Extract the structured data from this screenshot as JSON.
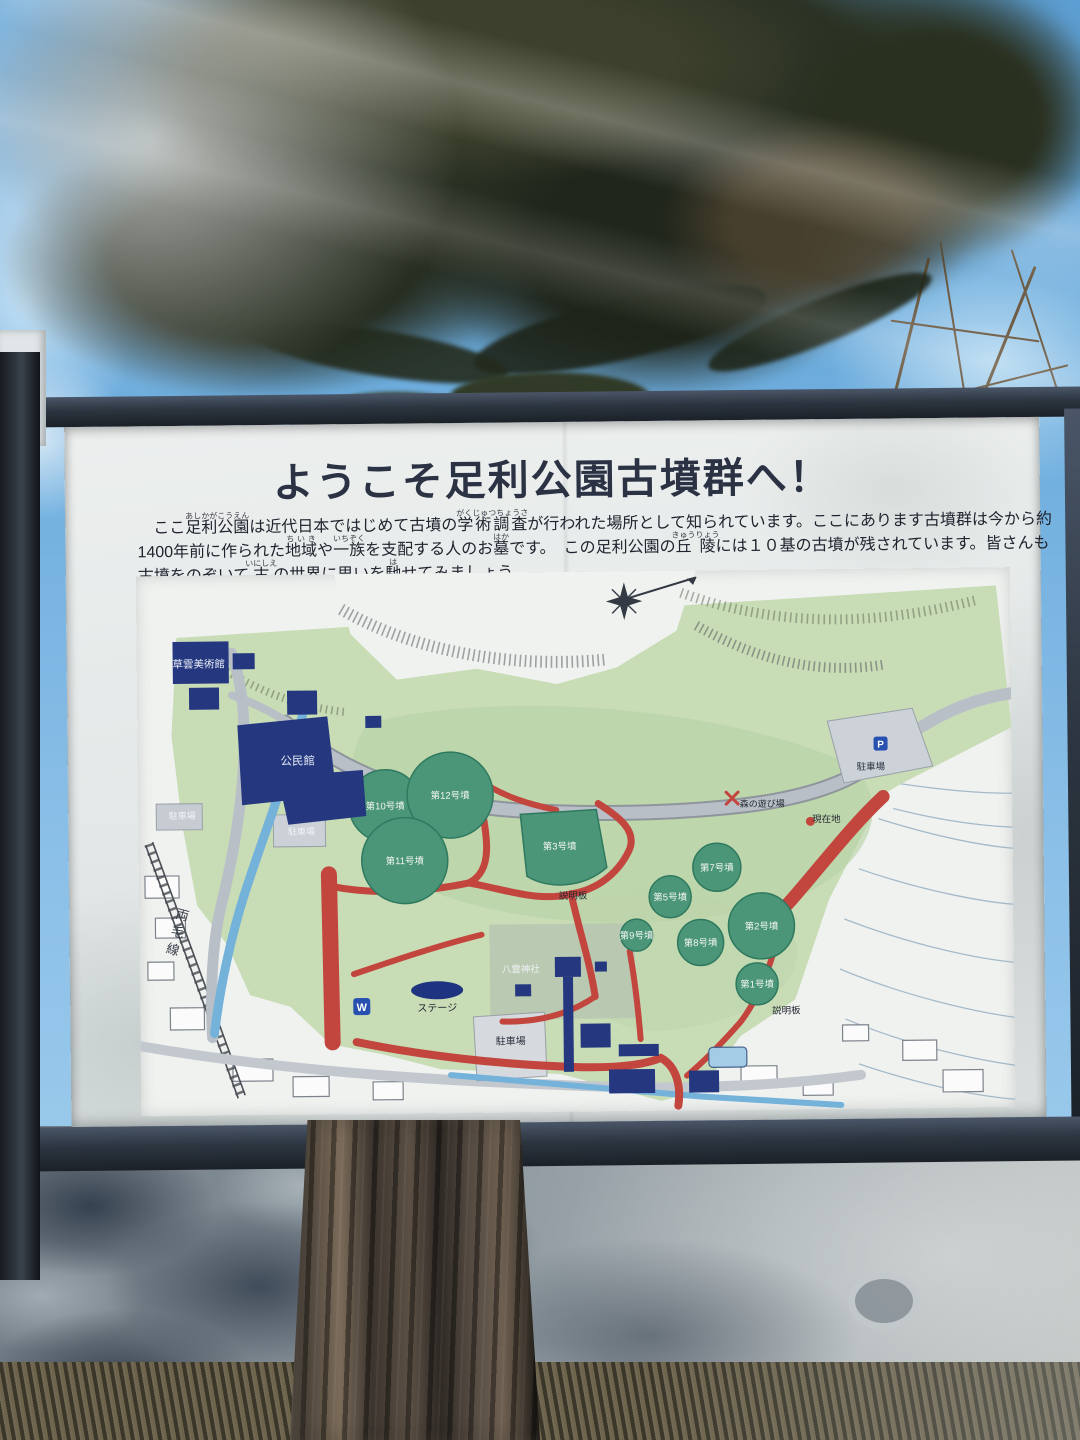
{
  "sign": {
    "title": "ようこそ足利公園古墳群へ！",
    "paragraph": {
      "lines": [
        {
          "segments": [
            {
              "t": "　ここ"
            },
            {
              "t": "足利公園",
              "ruby": "あしかがこうえん"
            },
            {
              "t": "は近代日本ではじめて古墳の"
            },
            {
              "t": "学術調査",
              "ruby": "がくじゅつちょうさ"
            },
            {
              "t": "が行われた場所として知られています。ここにあります古墳群は今から約"
            }
          ]
        },
        {
          "segments": [
            {
              "t": "1400年前に作られた"
            },
            {
              "t": "地域",
              "ruby": "ちいき"
            },
            {
              "t": "や"
            },
            {
              "t": "一族",
              "ruby": "いちぞく"
            },
            {
              "t": "を支配する人のお"
            },
            {
              "t": "墓",
              "ruby": "はか"
            },
            {
              "t": "です。　この足利公園の"
            },
            {
              "t": "丘陵",
              "ruby": "きゅうりょう"
            },
            {
              "t": "には１０基の古墳が残されています。皆さんも"
            }
          ]
        },
        {
          "segments": [
            {
              "t": "古墳をのぞいて"
            },
            {
              "t": "古",
              "ruby": "いにしえ"
            },
            {
              "t": "の世界に思いを"
            },
            {
              "t": "馳",
              "ruby": "は"
            },
            {
              "t": "せてみましょう。"
            }
          ]
        }
      ]
    },
    "map": {
      "colors": {
        "park_green": "#c8dcb6",
        "hill_green": "#b9d2a6",
        "mound_green": "#4b9678",
        "mound_rim": "#2f7a5f",
        "trail_red": "#c2463e",
        "water_blue": "#74b2da",
        "building_navy": "#24377f",
        "road_gray": "#b9bfc7",
        "label_white": "#eef2f5",
        "label_dark": "#262b33"
      },
      "mounds": [
        {
          "name": "第10号墳",
          "cx": 247,
          "cy": 232,
          "r": 36
        },
        {
          "name": "第12号墳",
          "cx": 312,
          "cy": 222,
          "r": 43
        },
        {
          "name": "第11号墳",
          "cx": 266,
          "cy": 287,
          "r": 43
        },
        {
          "name": "第3号墳",
          "shape": "fan",
          "cx": 421,
          "cy": 274,
          "r": 0
        },
        {
          "name": "第7号墳",
          "cx": 578,
          "cy": 297,
          "r": 24
        },
        {
          "name": "第5号墳",
          "cx": 531,
          "cy": 326,
          "r": 21
        },
        {
          "name": "第2号墳",
          "cx": 622,
          "cy": 356,
          "r": 33
        },
        {
          "name": "第9号墳",
          "cx": 497,
          "cy": 364,
          "r": 16
        },
        {
          "name": "第8号墳",
          "cx": 561,
          "cy": 372,
          "r": 23
        },
        {
          "name": "第1号墳",
          "cx": 617,
          "cy": 414,
          "r": 21
        }
      ],
      "labels": [
        {
          "text": "草雲美術館",
          "x": 62,
          "y": 92,
          "size": 10.5,
          "color": "#e9eef6"
        },
        {
          "text": "公民館",
          "x": 160,
          "y": 190,
          "size": 11.5,
          "color": "#e2e9f2"
        },
        {
          "text": "駐車場",
          "x": 44,
          "y": 243,
          "size": 9,
          "color": "#f0f3f6"
        },
        {
          "text": "駐車場",
          "x": 163,
          "y": 260,
          "size": 9,
          "color": "#eef2f5"
        },
        {
          "text": "駐車場",
          "x": 733,
          "y": 201,
          "size": 9.5,
          "color": "#2c3340"
        },
        {
          "text": "駐車場",
          "x": 370,
          "y": 472,
          "size": 10,
          "color": "#2c3340"
        },
        {
          "text": "説明板",
          "x": 434,
          "y": 327,
          "size": 9.5,
          "color": "#20262e"
        },
        {
          "text": "説明板",
          "x": 646,
          "y": 444,
          "size": 9.5,
          "color": "#20262e"
        },
        {
          "text": "ステージ",
          "x": 297,
          "y": 438,
          "size": 10,
          "color": "#222831"
        },
        {
          "text": "八雲神社",
          "x": 381,
          "y": 400,
          "size": 9.5,
          "color": "#edf1f4"
        },
        {
          "text": "森の遊び場",
          "x": 624,
          "y": 237,
          "size": 9,
          "color": "#262b33"
        },
        {
          "text": "現在地",
          "x": 688,
          "y": 253,
          "size": 9.5,
          "color": "#262b33"
        },
        {
          "text": "両毛線",
          "x": 44,
          "y": 332,
          "size": 13,
          "color": "#3a4148",
          "vertical": true
        }
      ],
      "icons": [
        {
          "name": "wc-icon",
          "glyph": "W"
        },
        {
          "name": "parking-icon",
          "glyph": "P"
        },
        {
          "name": "compass-rose-icon",
          "glyph": "✴"
        },
        {
          "name": "current-location-marker",
          "glyph": "●"
        },
        {
          "name": "playground-marker",
          "glyph": "✕"
        }
      ]
    }
  }
}
